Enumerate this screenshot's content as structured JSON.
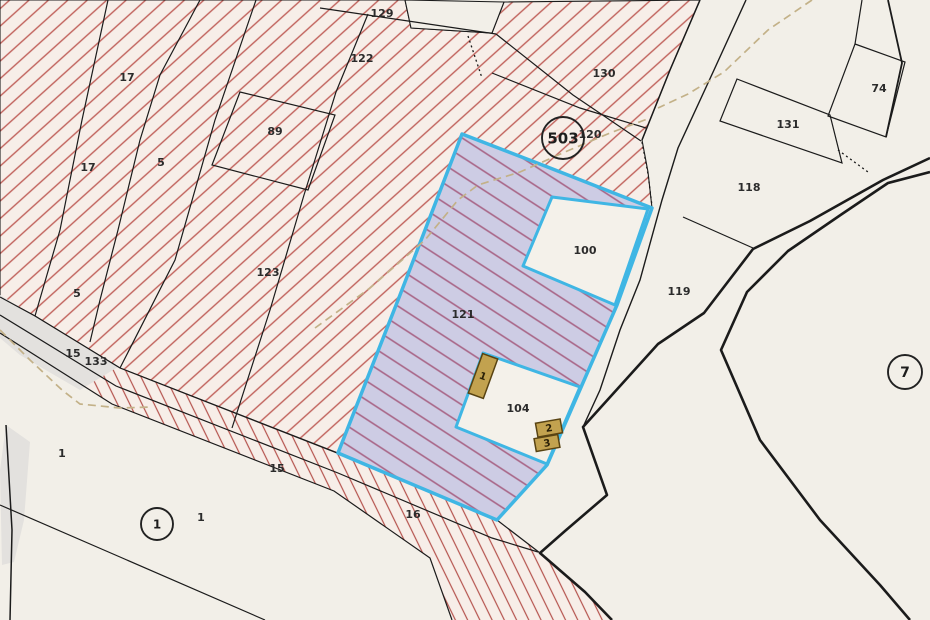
{
  "map": {
    "type": "cadastral-parcel-map",
    "colors": {
      "background": "#f2efe8",
      "hatch_red": "#c0605a",
      "hatch_area_tint": "#f7eee8",
      "highlight_border_cyan": "#3fb6e4",
      "highlight_fill_lavender": "#c9c8e4",
      "highlight_hatch_purple": "#a0567c",
      "building_fill": "#c2a24f",
      "building_border": "#584312",
      "path_dash_tan": "#c3b188",
      "boundary_black": "#1b1b1b",
      "gray_area": "#e3e1de"
    },
    "highlighted_parcel": {
      "label": "121",
      "inner_white_parcels": [
        "100",
        "104"
      ]
    },
    "parcel_labels": [
      {
        "t": "17",
        "x": 127,
        "y": 77
      },
      {
        "t": "17",
        "x": 88,
        "y": 167
      },
      {
        "t": "5",
        "x": 161,
        "y": 162
      },
      {
        "t": "5",
        "x": 77,
        "y": 293
      },
      {
        "t": "89",
        "x": 275,
        "y": 131
      },
      {
        "t": "122",
        "x": 362,
        "y": 58
      },
      {
        "t": "129",
        "x": 382,
        "y": 13
      },
      {
        "t": "123",
        "x": 268,
        "y": 272
      },
      {
        "t": "130",
        "x": 604,
        "y": 73
      },
      {
        "t": "120",
        "x": 590,
        "y": 134
      },
      {
        "t": "121",
        "x": 463,
        "y": 314
      },
      {
        "t": "100",
        "x": 585,
        "y": 250
      },
      {
        "t": "104",
        "x": 518,
        "y": 408
      },
      {
        "t": "119",
        "x": 679,
        "y": 291
      },
      {
        "t": "118",
        "x": 749,
        "y": 187
      },
      {
        "t": "131",
        "x": 788,
        "y": 124
      },
      {
        "t": "74",
        "x": 879,
        "y": 88
      },
      {
        "t": "15",
        "x": 73,
        "y": 353
      },
      {
        "t": "133",
        "x": 96,
        "y": 361
      },
      {
        "t": "15",
        "x": 277,
        "y": 468
      },
      {
        "t": "16",
        "x": 413,
        "y": 514
      },
      {
        "t": "1",
        "x": 62,
        "y": 453
      },
      {
        "t": "1",
        "x": 201,
        "y": 517
      }
    ],
    "circled_labels": [
      {
        "t": "503",
        "x": 563,
        "y": 138,
        "r": 21,
        "fs": 15
      },
      {
        "t": "7",
        "x": 905,
        "y": 372,
        "r": 17,
        "fs": 14
      },
      {
        "t": "1",
        "x": 157,
        "y": 524,
        "r": 16,
        "fs": 12
      }
    ],
    "buildings": [
      {
        "label": "1",
        "cx": 483,
        "cy": 376,
        "w": 16,
        "h": 42,
        "rot": 20
      },
      {
        "label": "2",
        "cx": 549,
        "cy": 428,
        "w": 25,
        "h": 14,
        "rot": -10
      },
      {
        "label": "3",
        "cx": 547,
        "cy": 443,
        "w": 24,
        "h": 13,
        "rot": -10
      }
    ]
  }
}
